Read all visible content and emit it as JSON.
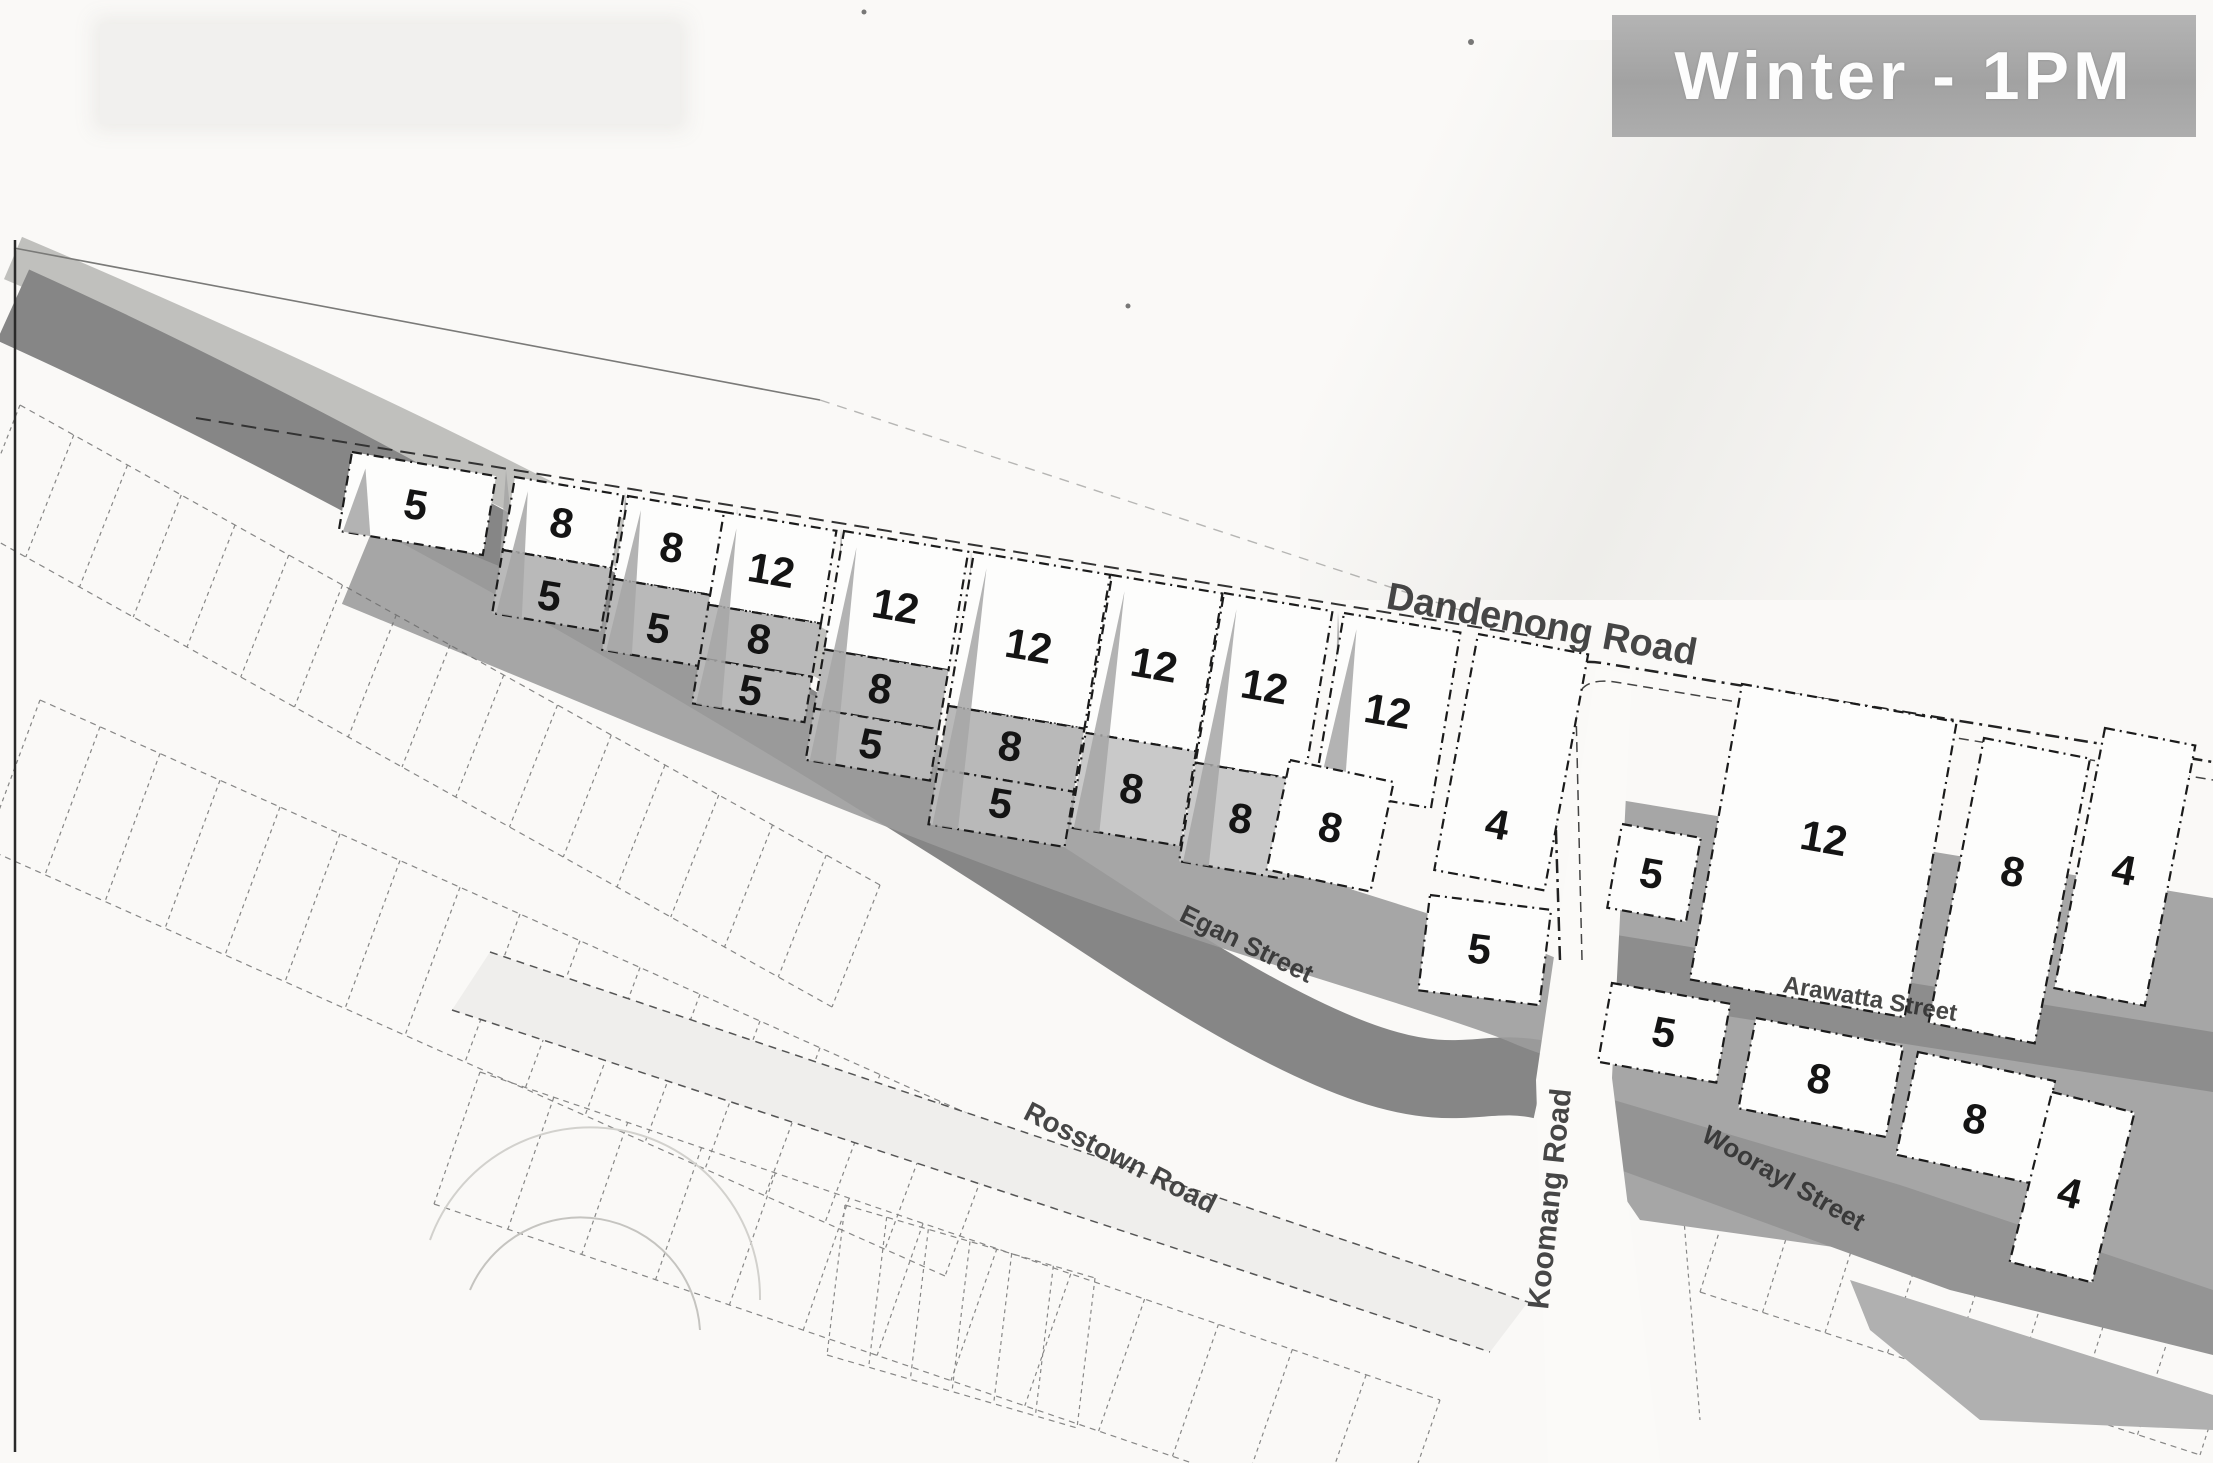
{
  "title": {
    "banner_label": "Winter - 1PM"
  },
  "faded_banner": {
    "visible_text": ""
  },
  "map": {
    "streets": {
      "dandenong": "Dandenong Road",
      "egan": "Egan Street",
      "rosstown": "Rosstown Road",
      "koomang": "Koomang Road",
      "arawatta": "Arawatta Street",
      "woorayl": "Woorayl Street"
    },
    "lot_values": [
      "5",
      "8",
      "5",
      "8",
      "5",
      "12",
      "8",
      "5",
      "12",
      "8",
      "5",
      "12",
      "8",
      "5",
      "12",
      "8",
      "12",
      "8",
      "12",
      "8",
      "4",
      "5",
      "5",
      "12",
      "8",
      "4",
      "5",
      "8",
      "8",
      "4"
    ],
    "colors": {
      "banner_bg": "#a8a8a8",
      "banner_text": "#fdfdfd",
      "shadow_dark": "#868686",
      "shadow_mid": "#9c9c9c",
      "shadow_light": "#b2b1ae",
      "lot_fill": "#fdfdfc",
      "lot_shaded": "#b9b9b9",
      "ink": "#1b1b1b"
    }
  }
}
